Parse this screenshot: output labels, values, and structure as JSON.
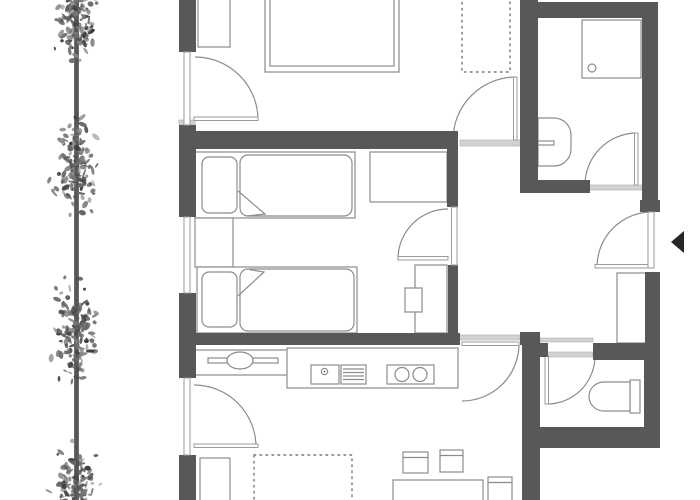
{
  "meta": {
    "title": "apartment-floor-plan",
    "canvas": {
      "w": 700,
      "h": 500
    }
  },
  "colors": {
    "wall": "#585858",
    "outline": "#8c8c8c",
    "threshold": "#d2d2d2",
    "glazing": "#9b9b9b",
    "dotted": "#777777",
    "arrow": "#262626",
    "trunk": "#6b6b6b",
    "leaves": [
      "#3c3c3c",
      "#4a4a4a",
      "#575757",
      "#666666",
      "#777777",
      "#8a8a8a"
    ],
    "background": "#ffffff"
  },
  "sections": [
    {
      "name": "thresholds",
      "items": [
        {
          "t": "rect",
          "n": "threshold",
          "s": "light",
          "d": [
            179,
            120,
            16,
            5
          ]
        },
        {
          "t": "rect",
          "n": "threshold",
          "s": "light",
          "d": [
            460,
            140,
            60,
            6
          ]
        },
        {
          "t": "rect",
          "n": "threshold",
          "s": "light",
          "d": [
            580,
            185,
            62,
            5
          ]
        },
        {
          "t": "rect",
          "n": "threshold",
          "s": "light",
          "d": [
            458,
            335,
            62,
            5
          ]
        },
        {
          "t": "rect",
          "n": "threshold",
          "s": "light",
          "d": [
            540,
            338,
            53,
            4
          ]
        },
        {
          "t": "rect",
          "n": "threshold",
          "s": "light",
          "d": [
            545,
            352,
            48,
            5
          ]
        }
      ]
    },
    {
      "name": "furniture",
      "items": [
        {
          "t": "rect",
          "n": "wardrobe",
          "s": "thin",
          "d": [
            198,
            -2,
            32,
            49
          ]
        },
        {
          "t": "rect",
          "n": "double-bed-frame",
          "s": "thin",
          "d": [
            265,
            -8,
            134,
            80
          ]
        },
        {
          "t": "rect",
          "n": "double-bed-mattress",
          "s": "thin",
          "d": [
            270,
            -4,
            124,
            70
          ]
        },
        {
          "t": "rect",
          "n": "dotted-closet",
          "s": "dotted",
          "d": [
            462,
            -4,
            48,
            76
          ]
        },
        {
          "t": "rect",
          "n": "single-bed-frame",
          "s": "thin",
          "d": [
            195,
            152,
            160,
            66
          ]
        },
        {
          "t": "rect",
          "n": "pillow",
          "s": "thin",
          "d": [
            202,
            157,
            35,
            56
          ],
          "rx": 7
        },
        {
          "t": "rect",
          "n": "duvet",
          "s": "thin",
          "d": [
            240,
            155,
            112,
            61
          ],
          "rx": 8
        },
        {
          "t": "path",
          "n": "duvet-fold",
          "s": "thinNF",
          "d": "M238,191 L265,214 L247,216"
        },
        {
          "t": "rect",
          "n": "nightstand",
          "s": "thin",
          "d": [
            195,
            218,
            38,
            49
          ]
        },
        {
          "t": "rect",
          "n": "single-bed-frame",
          "s": "thin",
          "d": [
            197,
            267,
            160,
            66
          ]
        },
        {
          "t": "rect",
          "n": "pillow",
          "s": "thin",
          "d": [
            202,
            272,
            35,
            55
          ],
          "rx": 7
        },
        {
          "t": "rect",
          "n": "duvet",
          "s": "thin",
          "d": [
            240,
            269,
            114,
            62
          ],
          "rx": 8
        },
        {
          "t": "path",
          "n": "duvet-fold",
          "s": "thinNF",
          "d": "M238,296 L264,272 L249,269.5"
        },
        {
          "t": "rect",
          "n": "desk",
          "s": "thin",
          "d": [
            370,
            152,
            77,
            50
          ]
        },
        {
          "t": "rect",
          "n": "wardrobe",
          "s": "thin",
          "d": [
            415,
            265,
            32,
            68
          ]
        },
        {
          "t": "rect",
          "n": "stool",
          "s": "thin",
          "d": [
            405,
            288,
            17,
            24
          ]
        },
        {
          "t": "rect",
          "n": "shower-tray",
          "s": "thin",
          "d": [
            582,
            20,
            59,
            58
          ]
        },
        {
          "t": "circle",
          "n": "shower-drain",
          "s": "thinNF",
          "d": [
            592,
            68,
            4
          ]
        },
        {
          "t": "path",
          "n": "washbasin",
          "s": "thin",
          "d": "M538,118 L554,118 A17,17 0 0 1 571,135 L571,149 A17,17 0 0 1 554,166 L538,166 Z"
        },
        {
          "t": "rect",
          "n": "faucet",
          "s": "thin",
          "d": [
            538,
            141,
            16,
            4
          ]
        },
        {
          "t": "rect",
          "n": "toilet-cistern",
          "s": "thin",
          "d": [
            630,
            380,
            10,
            33
          ]
        },
        {
          "t": "path",
          "n": "toilet-bowl",
          "s": "thin",
          "d": "M630,382 L604,382 A15,14.5 0 0 0 589,396.5 A15,14.5 0 0 0 604,411 L630,411 Z"
        },
        {
          "t": "rect",
          "n": "kitchen-sideboard",
          "s": "thin",
          "d": [
            195,
            350,
            93,
            25
          ]
        },
        {
          "t": "rect",
          "n": "sideboard-bar",
          "s": "thin",
          "d": [
            208,
            358,
            70,
            5
          ]
        },
        {
          "t": "ellipse",
          "n": "oval-sink",
          "s": "thin",
          "d": [
            240,
            360.5,
            13,
            8.5
          ]
        },
        {
          "t": "rect",
          "n": "kitchen-counter",
          "s": "thin",
          "d": [
            287,
            348,
            171,
            40
          ]
        },
        {
          "t": "rect",
          "n": "kitchen-sink",
          "s": "thin",
          "d": [
            311,
            365,
            28,
            19
          ]
        },
        {
          "t": "circle",
          "n": "sink-drain",
          "s": "thinNF",
          "d": [
            324.5,
            371.5,
            3.2
          ]
        },
        {
          "t": "circle",
          "n": "sink-drain-dot",
          "s": "dark",
          "d": [
            324.5,
            371.5,
            0.8
          ]
        },
        {
          "t": "rect",
          "n": "drainer",
          "s": "thin",
          "d": [
            341,
            365,
            25,
            19
          ]
        },
        {
          "t": "path",
          "n": "drainer-lines",
          "s": "thinNF",
          "d": "M343,369 H364 M343,372.5 H364 M343,376 H364 M343,379.5 H364"
        },
        {
          "t": "rect",
          "n": "cooktop",
          "s": "thin",
          "d": [
            387,
            365,
            47,
            19
          ]
        },
        {
          "t": "circle",
          "n": "burner",
          "s": "thinNF",
          "d": [
            402,
            374.5,
            7
          ]
        },
        {
          "t": "circle",
          "n": "burner",
          "s": "thinNF",
          "d": [
            420,
            374.5,
            7
          ]
        },
        {
          "t": "rect",
          "n": "hall-wardrobe",
          "s": "thin",
          "d": [
            617,
            273,
            29,
            70
          ]
        },
        {
          "t": "rect",
          "n": "sofa",
          "s": "thin",
          "d": [
            200,
            458,
            30,
            44
          ]
        },
        {
          "t": "rect",
          "n": "rug",
          "s": "dotted",
          "d": [
            254,
            455,
            98,
            47
          ]
        },
        {
          "t": "rect",
          "n": "dining-table",
          "s": "thin",
          "d": [
            393,
            480,
            90,
            22
          ]
        },
        {
          "t": "rect",
          "n": "chair",
          "s": "thin",
          "d": [
            403,
            452,
            25,
            21
          ]
        },
        {
          "t": "path",
          "n": "chair-backrest",
          "s": "thinNF",
          "d": "M403,457.5 H428"
        },
        {
          "t": "rect",
          "n": "chair",
          "s": "thin",
          "d": [
            440,
            450,
            23,
            22
          ]
        },
        {
          "t": "path",
          "n": "chair-backrest",
          "s": "thinNF",
          "d": "M440,455.5 H463"
        },
        {
          "t": "rect",
          "n": "chair",
          "s": "thin",
          "d": [
            488,
            477,
            24,
            25
          ]
        },
        {
          "t": "path",
          "n": "chair-backrest",
          "s": "thinNF",
          "d": "M488,482.5 H512"
        }
      ]
    },
    {
      "name": "doors",
      "items": [
        {
          "t": "path",
          "n": "door-arc",
          "s": "thinNF",
          "d": "M195,57 A63,63 0 0 1 258,120"
        },
        {
          "t": "rect",
          "n": "door-leaf",
          "s": "glaze",
          "d": [
            194,
            117,
            64,
            3.5
          ]
        },
        {
          "t": "path",
          "n": "door-arc",
          "s": "thinNF",
          "d": "M516,77 A63,63 0 0 0 453,140"
        },
        {
          "t": "rect",
          "n": "door-leaf",
          "s": "glaze",
          "d": [
            513.5,
            77,
            3.5,
            63
          ]
        },
        {
          "t": "path",
          "n": "door-arc",
          "s": "thinNF",
          "d": "M637,133 A52,52 0 0 0 585,185"
        },
        {
          "t": "rect",
          "n": "door-leaf",
          "s": "glaze",
          "d": [
            634.5,
            133,
            3.5,
            52
          ]
        },
        {
          "t": "path",
          "n": "door-arc",
          "s": "thinNF",
          "d": "M448,209 A50,50 0 0 0 398,259"
        },
        {
          "t": "rect",
          "n": "door-leaf",
          "s": "glaze",
          "d": [
            398,
            256.5,
            50,
            3.5
          ]
        },
        {
          "t": "path",
          "n": "door-arc",
          "s": "thinNF",
          "d": "M652,212 A55,55 0 0 0 597,267"
        },
        {
          "t": "rect",
          "n": "door-leaf",
          "s": "glaze",
          "d": [
            595,
            264.5,
            57,
            3.5
          ]
        },
        {
          "t": "path",
          "n": "door-arc",
          "s": "thinNF",
          "d": "M519,344 A57,57 0 0 1 462,401"
        },
        {
          "t": "rect",
          "n": "door-leaf",
          "s": "glaze",
          "d": [
            462,
            342,
            57,
            3.5
          ]
        },
        {
          "t": "path",
          "n": "door-arc",
          "s": "thinNF",
          "d": "M547,404 A48,48 0 0 0 595,356"
        },
        {
          "t": "rect",
          "n": "door-leaf",
          "s": "glaze",
          "d": [
            545,
            356,
            3.5,
            48
          ]
        },
        {
          "t": "path",
          "n": "door-arc",
          "s": "thinNF",
          "d": "M194,385 A62,62 0 0 1 256,447"
        },
        {
          "t": "rect",
          "n": "door-leaf",
          "s": "glaze",
          "d": [
            194,
            444,
            64,
            3.5
          ]
        }
      ]
    },
    {
      "name": "walls",
      "items": [
        {
          "t": "rect",
          "n": "wall",
          "s": "wall",
          "d": [
            179,
            0,
            17,
            52
          ]
        },
        {
          "t": "rect",
          "n": "wall",
          "s": "wall",
          "d": [
            179,
            125,
            17,
            92
          ]
        },
        {
          "t": "rect",
          "n": "wall",
          "s": "wall",
          "d": [
            179,
            293,
            17,
            85
          ]
        },
        {
          "t": "rect",
          "n": "wall",
          "s": "wall",
          "d": [
            179,
            455,
            17,
            45
          ]
        },
        {
          "t": "rect",
          "n": "wall",
          "s": "wall",
          "d": [
            195,
            131,
            263,
            18
          ]
        },
        {
          "t": "rect",
          "n": "wall",
          "s": "wall",
          "d": [
            181,
            333,
            279,
            12
          ]
        },
        {
          "t": "rect",
          "n": "wall",
          "s": "wall",
          "d": [
            520,
            0,
            18,
            193
          ]
        },
        {
          "t": "rect",
          "n": "wall",
          "s": "wall",
          "d": [
            538,
            2,
            120,
            16
          ]
        },
        {
          "t": "rect",
          "n": "wall",
          "s": "wall",
          "d": [
            642,
            3,
            16,
            199
          ]
        },
        {
          "t": "rect",
          "n": "wall",
          "s": "wall",
          "d": [
            640,
            200,
            20,
            12
          ]
        },
        {
          "t": "rect",
          "n": "wall",
          "s": "wall",
          "d": [
            523,
            180,
            67,
            13
          ]
        },
        {
          "t": "rect",
          "n": "wall",
          "s": "wall",
          "d": [
            645,
            272,
            15,
            80
          ]
        },
        {
          "t": "rect",
          "n": "wall",
          "s": "wall",
          "d": [
            593,
            343,
            65,
            17
          ]
        },
        {
          "t": "rect",
          "n": "wall",
          "s": "wall",
          "d": [
            540,
            343,
            8,
            14
          ]
        },
        {
          "t": "rect",
          "n": "wall",
          "s": "wall",
          "d": [
            520,
            332,
            20,
            13
          ]
        },
        {
          "t": "rect",
          "n": "wall",
          "s": "wall",
          "d": [
            522,
            345,
            18,
            155
          ]
        },
        {
          "t": "rect",
          "n": "wall",
          "s": "wall",
          "d": [
            644,
            352,
            16,
            96
          ]
        },
        {
          "t": "rect",
          "n": "wall",
          "s": "wall",
          "d": [
            540,
            427,
            120,
            21
          ]
        },
        {
          "t": "rect",
          "n": "wall",
          "s": "wall",
          "d": [
            447,
            143,
            11,
            64
          ]
        },
        {
          "t": "rect",
          "n": "wall",
          "s": "wall",
          "d": [
            448,
            265,
            10,
            68
          ]
        }
      ]
    },
    {
      "name": "glazing",
      "items": [
        {
          "t": "rect",
          "n": "balcony-door-glazing",
          "s": "glaze",
          "d": [
            184,
            52,
            6,
            73
          ]
        },
        {
          "t": "rect",
          "n": "window",
          "s": "glaze",
          "d": [
            184,
            217,
            6,
            76
          ]
        },
        {
          "t": "rect",
          "n": "window",
          "s": "glaze",
          "d": [
            184,
            378,
            6,
            77
          ]
        },
        {
          "t": "rect",
          "n": "door-closed-leaf",
          "s": "glaze",
          "d": [
            451.5,
            207,
            5.5,
            58
          ]
        },
        {
          "t": "rect",
          "n": "entrance-door-leaf",
          "s": "glaze",
          "d": [
            648,
            212,
            6,
            56
          ]
        }
      ]
    },
    {
      "name": "markers",
      "items": [
        {
          "t": "polygon",
          "n": "entrance-arrow-icon",
          "s": "dark",
          "d": "684,231 671,242 684,253"
        }
      ]
    }
  ],
  "trees": {
    "trunk": {
      "x": 74,
      "w": 5,
      "core_x": 75.3,
      "core_w": 2.4
    },
    "cx": 76,
    "spread": 19,
    "clusters": [
      {
        "cy": 16,
        "h": 90
      },
      {
        "cy": 166,
        "h": 102
      },
      {
        "cy": 334,
        "h": 102
      },
      {
        "cy": 484,
        "h": 80
      }
    ],
    "leaf_density": 1.35,
    "seed": 7
  }
}
